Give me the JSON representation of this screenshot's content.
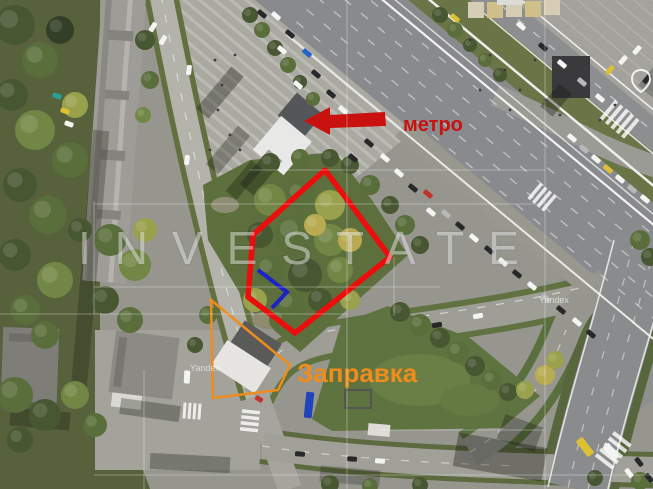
{
  "map": {
    "attribution": "Yandex",
    "watermark_brand": "INVESTATE"
  },
  "annotations": {
    "metro": {
      "label": "метро",
      "color": "#c9120f",
      "text_x": 403,
      "text_y": 131,
      "arrow_points": "304,121 330,107 330,115 385,112 386,126 330,128 330,135"
    },
    "plot": {
      "color": "#ec0d0d",
      "points": "325,170 390,257 295,333 248,297 253,235",
      "stroke_width": 5.5
    },
    "plot_entry": {
      "color": "#1b23c4",
      "points": "258,270 287,292 272,308",
      "stroke_width": 4
    },
    "gas_station": {
      "label": "Заправка",
      "color": "#ef8c1c",
      "points": "211,300 290,365 278,390 213,398",
      "stroke_width": 2.5,
      "text_x": 297,
      "text_y": 382
    }
  },
  "watermark": {
    "grid": [
      [
        144,
        370,
        144,
        489
      ],
      [
        347,
        0,
        347,
        489
      ],
      [
        545,
        0,
        545,
        489
      ],
      [
        94,
        201,
        94,
        314
      ],
      [
        394,
        257,
        394,
        316
      ],
      [
        94,
        204,
        545,
        204
      ],
      [
        0,
        314,
        347,
        314
      ],
      [
        94,
        287,
        440,
        287
      ],
      [
        250,
        170,
        545,
        170
      ],
      [
        380,
        430,
        545,
        430
      ],
      [
        94,
        475,
        653,
        475
      ]
    ]
  },
  "scenery": {
    "tree_tones": [
      "#333f27",
      "#475731",
      "#5a6e3b",
      "#728745",
      "#99a14c",
      "#b9ab52"
    ],
    "trees": [
      [
        15,
        25,
        20,
        1
      ],
      [
        40,
        60,
        18,
        2
      ],
      [
        12,
        95,
        16,
        1
      ],
      [
        35,
        130,
        20,
        3
      ],
      [
        60,
        30,
        14,
        0
      ],
      [
        70,
        160,
        18,
        2
      ],
      [
        20,
        185,
        17,
        1
      ],
      [
        48,
        215,
        19,
        2
      ],
      [
        15,
        255,
        16,
        1
      ],
      [
        55,
        280,
        18,
        3
      ],
      [
        25,
        310,
        15,
        2
      ],
      [
        75,
        105,
        13,
        4
      ],
      [
        80,
        230,
        12,
        1
      ],
      [
        45,
        335,
        14,
        2
      ],
      [
        15,
        395,
        18,
        2
      ],
      [
        45,
        415,
        16,
        1
      ],
      [
        75,
        395,
        14,
        3
      ],
      [
        20,
        440,
        13,
        1
      ],
      [
        95,
        425,
        12,
        2
      ],
      [
        110,
        240,
        16,
        2
      ],
      [
        135,
        265,
        16,
        3
      ],
      [
        105,
        300,
        14,
        1
      ],
      [
        130,
        320,
        13,
        2
      ],
      [
        145,
        230,
        12,
        4
      ],
      [
        145,
        40,
        10,
        1
      ],
      [
        150,
        80,
        9,
        2
      ],
      [
        143,
        115,
        8,
        3
      ],
      [
        270,
        200,
        16,
        3
      ],
      [
        300,
        195,
        14,
        2
      ],
      [
        330,
        205,
        15,
        4
      ],
      [
        260,
        235,
        13,
        1
      ],
      [
        295,
        235,
        20,
        2
      ],
      [
        330,
        240,
        16,
        3
      ],
      [
        270,
        270,
        14,
        2
      ],
      [
        305,
        275,
        17,
        1
      ],
      [
        340,
        270,
        13,
        3
      ],
      [
        255,
        300,
        12,
        4
      ],
      [
        290,
        305,
        15,
        2
      ],
      [
        320,
        300,
        12,
        1
      ],
      [
        350,
        240,
        12,
        5
      ],
      [
        315,
        225,
        11,
        5
      ],
      [
        280,
        320,
        11,
        2
      ],
      [
        350,
        300,
        10,
        4
      ],
      [
        350,
        165,
        9,
        1
      ],
      [
        370,
        185,
        10,
        2
      ],
      [
        390,
        205,
        9,
        1
      ],
      [
        405,
        225,
        10,
        2
      ],
      [
        420,
        245,
        9,
        1
      ],
      [
        270,
        163,
        10,
        1
      ],
      [
        300,
        158,
        9,
        2
      ],
      [
        330,
        158,
        9,
        1
      ],
      [
        250,
        15,
        8,
        1
      ],
      [
        262,
        30,
        8,
        2
      ],
      [
        275,
        48,
        8,
        1
      ],
      [
        288,
        65,
        8,
        2
      ],
      [
        300,
        82,
        7,
        1
      ],
      [
        313,
        99,
        7,
        2
      ],
      [
        440,
        15,
        8,
        1
      ],
      [
        455,
        30,
        8,
        2
      ],
      [
        470,
        45,
        7,
        1
      ],
      [
        485,
        60,
        7,
        2
      ],
      [
        500,
        75,
        7,
        1
      ],
      [
        400,
        312,
        10,
        1
      ],
      [
        420,
        325,
        11,
        2
      ],
      [
        440,
        338,
        10,
        1
      ],
      [
        458,
        352,
        11,
        2
      ],
      [
        475,
        366,
        10,
        1
      ],
      [
        492,
        380,
        10,
        2
      ],
      [
        508,
        392,
        9,
        1
      ],
      [
        525,
        390,
        9,
        4
      ],
      [
        545,
        375,
        10,
        5
      ],
      [
        555,
        360,
        9,
        4
      ],
      [
        208,
        315,
        9,
        2
      ],
      [
        195,
        345,
        8,
        1
      ],
      [
        640,
        240,
        10,
        2
      ],
      [
        650,
        257,
        9,
        1
      ],
      [
        330,
        484,
        9,
        1
      ],
      [
        370,
        486,
        8,
        2
      ],
      [
        420,
        485,
        8,
        1
      ],
      [
        595,
        478,
        8,
        1
      ],
      [
        640,
        481,
        9,
        2
      ]
    ],
    "shadows": [
      [
        212,
        65,
        16,
        55,
        40,
        0.35
      ],
      [
        220,
        125,
        16,
        50,
        40,
        0.3
      ],
      [
        237,
        160,
        14,
        40,
        40,
        0.3
      ],
      [
        252,
        150,
        18,
        45,
        40,
        0.35
      ],
      [
        82,
        130,
        16,
        260,
        5,
        0.28
      ],
      [
        548,
        85,
        16,
        30,
        40,
        0.35
      ],
      [
        10,
        410,
        60,
        18,
        5,
        0.3
      ],
      [
        120,
        402,
        60,
        16,
        8,
        0.3
      ],
      [
        455,
        440,
        90,
        34,
        10,
        0.35
      ],
      [
        500,
        420,
        40,
        26,
        20,
        0.3
      ],
      [
        320,
        468,
        60,
        16,
        5,
        0.25
      ],
      [
        150,
        455,
        80,
        16,
        3,
        0.3
      ],
      [
        660,
        25,
        60,
        90,
        40,
        0.25
      ]
    ],
    "vehicle_colors": {
      "w": "#f4f4f2",
      "d": "#28282b",
      "s": "#b7b8ba",
      "r": "#c03328",
      "b": "#2563c9",
      "y": "#ddc133",
      "t": "#2aa198",
      "B": "#2244bb"
    },
    "vehicles": [
      [
        276,
        16,
        40,
        "w",
        10,
        5
      ],
      [
        262,
        14,
        40,
        "d",
        10,
        5
      ],
      [
        290,
        34,
        40,
        "d",
        10,
        5
      ],
      [
        282,
        50,
        40,
        "w",
        10,
        5
      ],
      [
        307,
        53,
        40,
        "b",
        10,
        5
      ],
      [
        316,
        74,
        40,
        "d",
        10,
        5
      ],
      [
        298,
        85,
        40,
        "w",
        10,
        5
      ],
      [
        331,
        94,
        40,
        "d",
        10,
        5
      ],
      [
        343,
        110,
        40,
        "w",
        10,
        5
      ],
      [
        322,
        118,
        40,
        "d",
        10,
        5
      ],
      [
        357,
        126,
        40,
        "s",
        10,
        5
      ],
      [
        369,
        143,
        40,
        "d",
        10,
        5
      ],
      [
        385,
        158,
        40,
        "w",
        10,
        5
      ],
      [
        353,
        158,
        40,
        "d",
        10,
        5
      ],
      [
        399,
        173,
        40,
        "w",
        10,
        5
      ],
      [
        428,
        194,
        40,
        "r",
        10,
        5
      ],
      [
        413,
        188,
        40,
        "d",
        10,
        5
      ],
      [
        431,
        212,
        40,
        "w",
        10,
        5
      ],
      [
        446,
        214,
        40,
        "s",
        10,
        5
      ],
      [
        460,
        226,
        40,
        "d",
        10,
        5
      ],
      [
        474,
        238,
        40,
        "w",
        10,
        5
      ],
      [
        489,
        250,
        40,
        "d",
        10,
        5
      ],
      [
        503,
        262,
        40,
        "w",
        10,
        5
      ],
      [
        517,
        274,
        40,
        "d",
        10,
        5
      ],
      [
        532,
        286,
        40,
        "w",
        10,
        5
      ],
      [
        546,
        298,
        40,
        "s",
        10,
        5
      ],
      [
        561,
        310,
        40,
        "d",
        10,
        5
      ],
      [
        577,
        322,
        40,
        "w",
        10,
        5
      ],
      [
        591,
        334,
        40,
        "d",
        10,
        5
      ],
      [
        455,
        18,
        40,
        "y",
        10,
        5
      ],
      [
        521,
        26,
        40,
        "w",
        10,
        5
      ],
      [
        543,
        47,
        40,
        "d",
        10,
        5
      ],
      [
        562,
        64,
        40,
        "w",
        10,
        5
      ],
      [
        582,
        82,
        40,
        "s",
        10,
        5
      ],
      [
        600,
        98,
        40,
        "w",
        10,
        5
      ],
      [
        572,
        138,
        40,
        "w",
        10,
        5
      ],
      [
        584,
        149,
        40,
        "s",
        10,
        5
      ],
      [
        596,
        159,
        40,
        "w",
        10,
        5
      ],
      [
        608,
        169,
        40,
        "y",
        10,
        5
      ],
      [
        620,
        179,
        40,
        "w",
        10,
        5
      ],
      [
        632,
        189,
        40,
        "s",
        10,
        5
      ],
      [
        645,
        199,
        40,
        "w",
        10,
        5
      ],
      [
        610,
        70,
        130,
        "y",
        10,
        5
      ],
      [
        623,
        60,
        130,
        "w",
        10,
        5
      ],
      [
        637,
        50,
        130,
        "w",
        10,
        5
      ],
      [
        647,
        79,
        130,
        "d",
        10,
        5
      ],
      [
        153,
        27,
        120,
        "w",
        10,
        5
      ],
      [
        163,
        40,
        120,
        "w",
        10,
        5
      ],
      [
        57,
        96,
        20,
        "t",
        9,
        5
      ],
      [
        65,
        111,
        20,
        "y",
        9,
        5
      ],
      [
        69,
        124,
        20,
        "w",
        9,
        5
      ],
      [
        189,
        70,
        97,
        "w",
        10,
        5
      ],
      [
        187,
        160,
        97,
        "w",
        10,
        5
      ],
      [
        187,
        377,
        93,
        "w",
        13,
        6
      ],
      [
        309,
        405,
        96,
        "B",
        26,
        8
      ],
      [
        478,
        316,
        -10,
        "w",
        10,
        5
      ],
      [
        437,
        325,
        -10,
        "d",
        10,
        5
      ],
      [
        352,
        459,
        4,
        "d",
        10,
        5
      ],
      [
        380,
        461,
        4,
        "w",
        10,
        5
      ],
      [
        300,
        454,
        4,
        "d",
        10,
        5
      ],
      [
        585,
        447,
        52,
        "y",
        20,
        8
      ],
      [
        611,
        452,
        52,
        "w",
        18,
        8
      ],
      [
        639,
        462,
        52,
        "d",
        10,
        5
      ],
      [
        629,
        473,
        52,
        "w",
        10,
        5
      ],
      [
        649,
        478,
        52,
        "d",
        10,
        5
      ],
      [
        259,
        399,
        30,
        "r",
        8,
        5
      ]
    ],
    "people": [
      [
        215,
        60
      ],
      [
        222,
        85
      ],
      [
        218,
        110
      ],
      [
        230,
        135
      ],
      [
        240,
        150
      ],
      [
        210,
        150
      ],
      [
        235,
        55
      ],
      [
        470,
        40
      ],
      [
        490,
        55
      ],
      [
        505,
        70
      ],
      [
        520,
        90
      ],
      [
        535,
        60
      ],
      [
        480,
        90
      ],
      [
        510,
        110
      ],
      [
        545,
        100
      ],
      [
        560,
        115
      ],
      [
        600,
        120
      ],
      [
        615,
        105
      ]
    ]
  }
}
